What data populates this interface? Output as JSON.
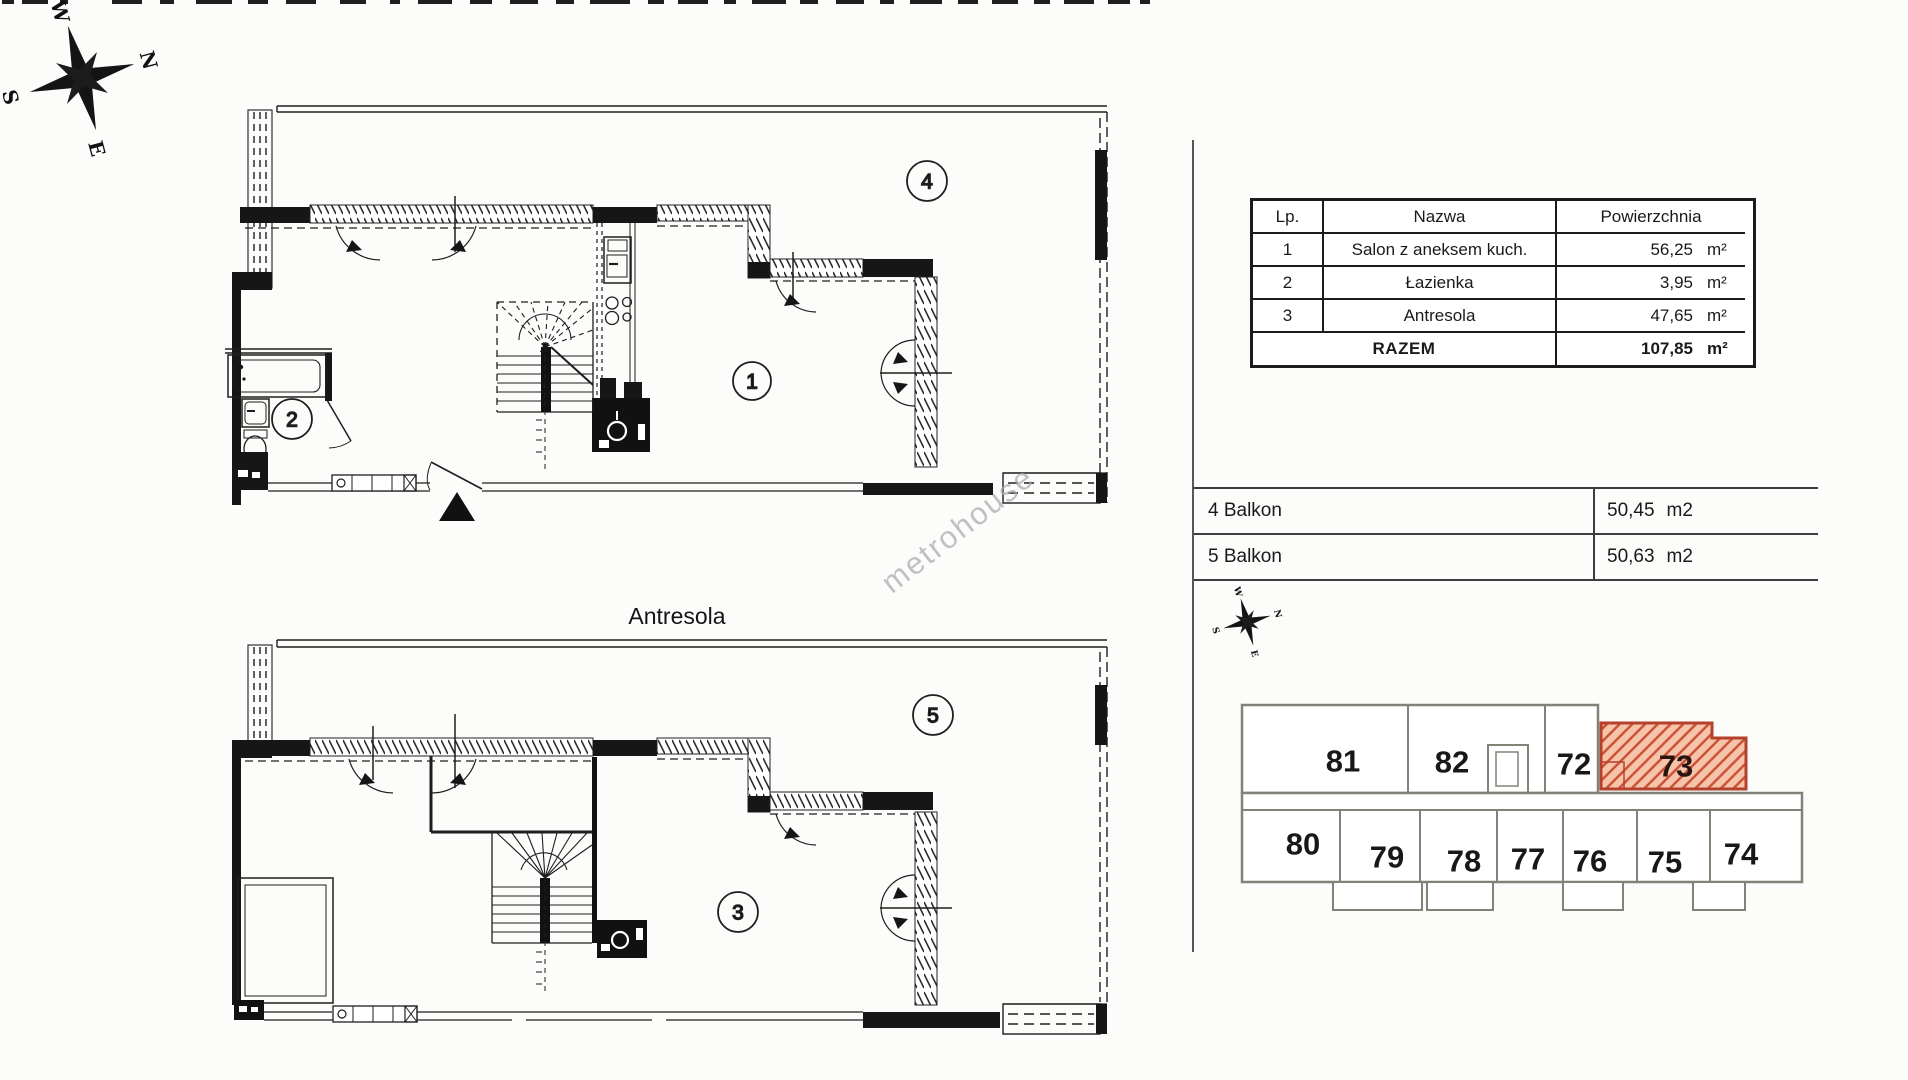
{
  "compass": {
    "labels": {
      "n": "N",
      "e": "E",
      "s": "S",
      "w": "W"
    }
  },
  "floor_plans": {
    "upper": {
      "living_label": "1",
      "bath_label": "2",
      "balcony_label": "4"
    },
    "lower": {
      "caption": "Antresola",
      "mezzanine_label": "3",
      "balcony_label": "5"
    }
  },
  "watermark": {
    "text": "metrohouse"
  },
  "area_table": {
    "header": {
      "lp": "Lp.",
      "name": "Nazwa",
      "area": "Powierzchnia"
    },
    "rows": [
      {
        "lp": "1",
        "name": "Salon z aneksem kuch.",
        "value": "56,25",
        "unit": "m²"
      },
      {
        "lp": "2",
        "name": "Łazienka",
        "value": "3,95",
        "unit": "m²"
      },
      {
        "lp": "3",
        "name": "Antresola",
        "value": "47,65",
        "unit": "m²"
      }
    ],
    "total": {
      "label": "RAZEM",
      "value": "107,85",
      "unit": "m²"
    }
  },
  "balcony_table": {
    "rows": [
      {
        "label": "4 Balkon",
        "value": "50,45",
        "unit": "m2"
      },
      {
        "label": "5 Balkon",
        "value": "50,63",
        "unit": "m2"
      }
    ]
  },
  "site_plan": {
    "highlighted_unit": "73",
    "units": {
      "u81": "81",
      "u82": "82",
      "u72": "72",
      "u73": "73",
      "u80": "80",
      "u79": "79",
      "u78": "78",
      "u77": "77",
      "u76": "76",
      "u75": "75",
      "u74": "74"
    },
    "colors": {
      "highlight_fill": "#f5c4ab",
      "highlight_stroke": "#b5402c",
      "wall": "#7f8477"
    }
  }
}
